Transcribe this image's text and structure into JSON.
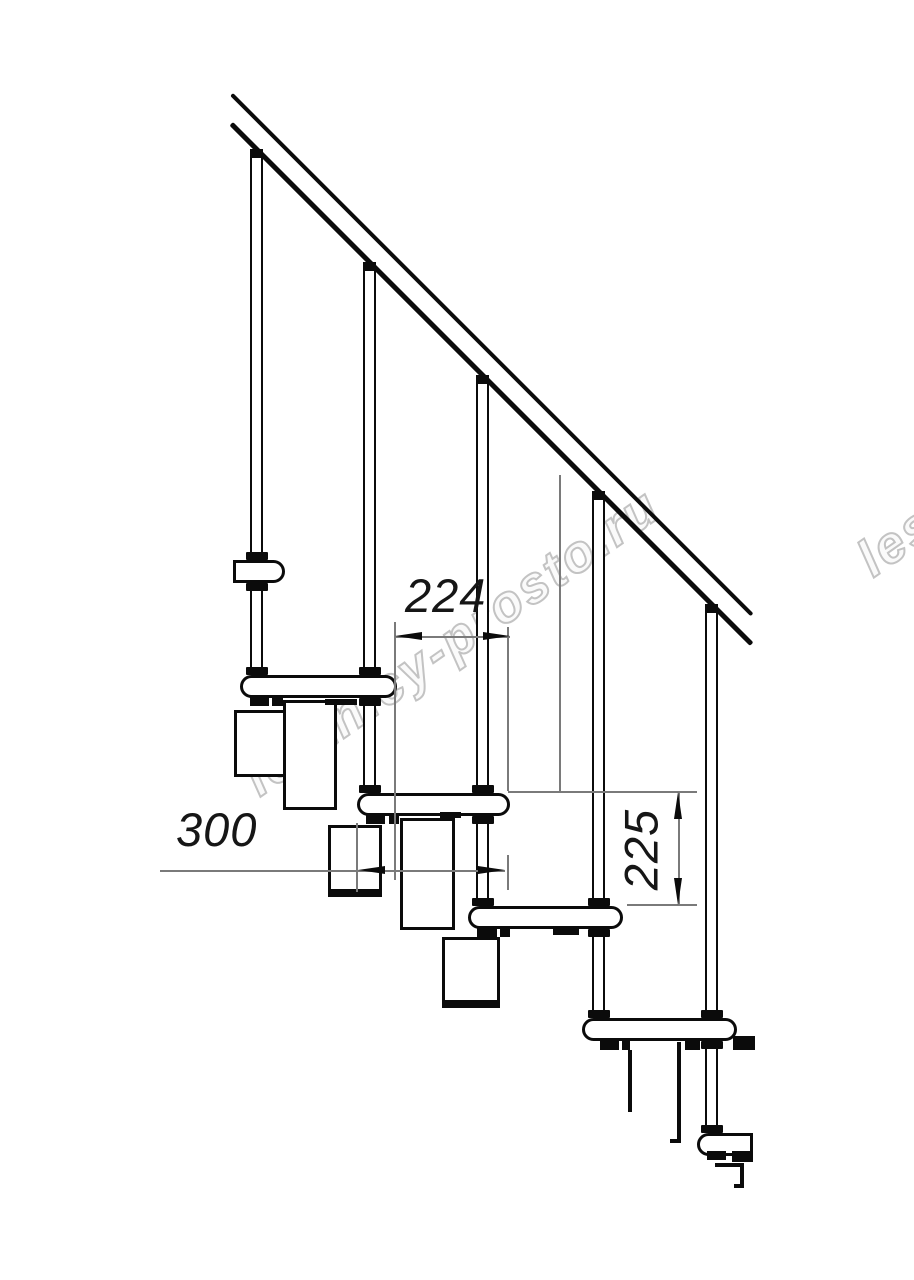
{
  "page": {
    "background": "#ffffff",
    "line_color": "#0b0b0b",
    "dim_line_color": "#7a7a7a",
    "watermark_color": "#c3c3c3"
  },
  "watermark": {
    "text": "lestnicy-prosto.ru",
    "fragment": "lest"
  },
  "dimensions": {
    "run_224": {
      "label": "224"
    },
    "depth_300": {
      "label": "300"
    },
    "rise_225": {
      "label": "225"
    }
  }
}
